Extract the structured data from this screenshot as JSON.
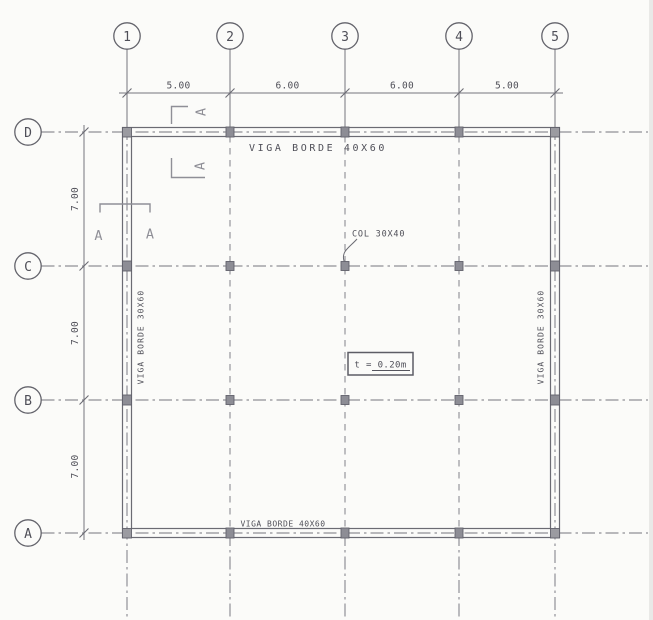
{
  "drawing": {
    "axes": {
      "vertical": [
        "1",
        "2",
        "3",
        "4",
        "5"
      ],
      "horizontal": [
        "D",
        "C",
        "B",
        "A"
      ]
    },
    "dimensions": {
      "horizontal": [
        "5.00",
        "6.00",
        "6.00",
        "5.00"
      ],
      "vertical": [
        "7.00",
        "7.00",
        "7.00"
      ]
    },
    "labels": {
      "top_beam": "VIGA BORDE 40X60",
      "bottom_beam": "VIGA BORDE 40X60",
      "left_beam": "VIGA BORDE 30X60",
      "right_beam": "VIGA BORDE 30X60",
      "column": "COL 30X40",
      "slab_thickness": "t = 0.20m",
      "section": "A"
    },
    "colors": {
      "paper": "#fbfbf9",
      "line": "#75757d",
      "beam": "#6b6b73",
      "text": "#4f4f58",
      "column_fill": "#8d8d95",
      "section_mark": "#8f8f97"
    }
  }
}
